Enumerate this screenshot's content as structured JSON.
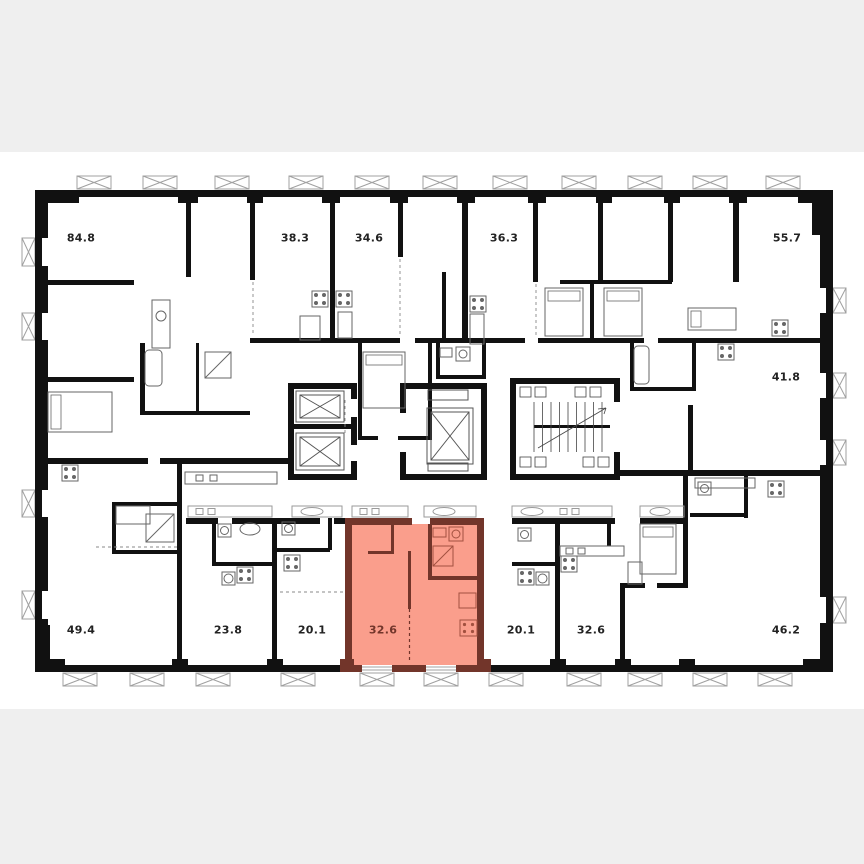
{
  "page": {
    "background_color": "#efefef",
    "canvas_color": "#ffffff"
  },
  "floor_plan": {
    "wall_color": "#111111",
    "detail_color": "#666666",
    "window_color": "#a0a0a0",
    "label_color": "#222222",
    "highlighted_unit": {
      "area_label": "32.6",
      "fill_color": "#fa9e8c",
      "wall_color": "#72352a",
      "fixture_color": "#a2503f"
    },
    "apartments": [
      {
        "area_label": "84.8",
        "x": 81,
        "y": 238,
        "highlighted": false
      },
      {
        "area_label": "38.3",
        "x": 295,
        "y": 238,
        "highlighted": false
      },
      {
        "area_label": "34.6",
        "x": 369,
        "y": 238,
        "highlighted": false
      },
      {
        "area_label": "36.3",
        "x": 504,
        "y": 238,
        "highlighted": false
      },
      {
        "area_label": "55.7",
        "x": 787,
        "y": 238,
        "highlighted": false
      },
      {
        "area_label": "41.8",
        "x": 786,
        "y": 377,
        "highlighted": false
      },
      {
        "area_label": "49.4",
        "x": 81,
        "y": 630,
        "highlighted": false
      },
      {
        "area_label": "23.8",
        "x": 228,
        "y": 630,
        "highlighted": false
      },
      {
        "area_label": "20.1",
        "x": 312,
        "y": 630,
        "highlighted": false
      },
      {
        "area_label": "32.6",
        "x": 383,
        "y": 630,
        "highlighted": true
      },
      {
        "area_label": "20.1",
        "x": 521,
        "y": 630,
        "highlighted": false
      },
      {
        "area_label": "32.6",
        "x": 591,
        "y": 630,
        "highlighted": false
      },
      {
        "area_label": "46.2",
        "x": 786,
        "y": 630,
        "highlighted": false
      }
    ]
  }
}
